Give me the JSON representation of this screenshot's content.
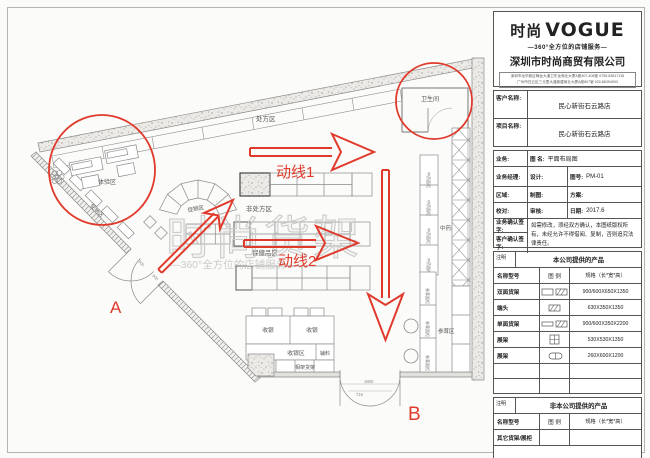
{
  "panel": {
    "logo_cn": "时尚",
    "logo_en": "VOGUE",
    "tagline": "—360°全方位的店铺服务—",
    "company": "深圳市时尚商贸有限公司",
    "address_line1": "深圳市龙华新区梅龙大道卫东龙商业大厦A座407-408室  0755-83617135",
    "address_line2": "广州市白云区三元里大道新建商业大厦A座807室  020-86394093",
    "info": {
      "client_label": "客户名称:",
      "client_value": "民心新街石云路店",
      "project_label": "项目名称:",
      "project_value": "民心新街石云路店"
    },
    "grid": {
      "yewu": "业务:",
      "tuming_label": "图 名:",
      "tuming_value": "平面布局图",
      "jingli": "业务经理:",
      "sheji": "设计:",
      "tuhao_label": "图号:",
      "tuhao_value": "PM-01",
      "quyu": "区域:",
      "zhitu": "制图:",
      "fangan": "方案:",
      "jiaodui": "校对:",
      "shenhe": "审核:",
      "riqi_label": "日期:",
      "riqi_value": "2017.6",
      "yewu_qianzi": "业务确认签字:",
      "kehu_qianzi": "客户确认签字:",
      "note": "如需修改，须经双方确认，本图纸版权所有，未经允许不得借阅、复制，否则追究法律责任。"
    },
    "products_company": {
      "note_label": "注明",
      "title": "本公司提供的产品",
      "col_name": "名称型号",
      "col_legend": "图 例",
      "col_spec": "规格（长*宽*高）",
      "rows": [
        {
          "name": "双面货架",
          "legend_icon": "double-sided-shelf-legend-icon",
          "spec": "900/600X650X1350"
        },
        {
          "name": "端头",
          "legend_icon": "endcap-legend-icon",
          "spec": "630X350X1350"
        },
        {
          "name": "单面货架",
          "legend_icon": "single-sided-shelf-legend-icon",
          "spec": "900/600X350X2200"
        },
        {
          "name": "展架",
          "legend_icon": "display-rack-legend-icon",
          "spec": "530X530X1350"
        },
        {
          "name": "展架",
          "legend_icon": "display-rack2-legend-icon",
          "spec": "260X600X1200"
        },
        {
          "name": "",
          "legend_icon": "",
          "spec": ""
        },
        {
          "name": "",
          "legend_icon": "",
          "spec": ""
        }
      ]
    },
    "products_other": {
      "note_label": "注明",
      "title": "非本公司提供的产品",
      "col_name": "名称型号",
      "col_legend": "图 例",
      "col_spec": "规格（长*宽*高）",
      "rows": [
        {
          "name": "其它货架/展柜",
          "legend_icon": "",
          "spec": ""
        }
      ]
    }
  },
  "plan": {
    "labels": {
      "prescription": "处方区",
      "toilet": "卫生间",
      "experience": "体验区",
      "promo_wall": "促销区",
      "promo_island": "促销区",
      "otc": "非处方区",
      "health": "保健品区",
      "tcm_area": "中药区",
      "ginseng_area": "参茸区",
      "cashier1": "收银",
      "cashier2": "收银",
      "cashier_area": "收银区",
      "accessories": "辅料",
      "bottom_shelf": "相架货架",
      "tcm_cabinet": "中药面柜",
      "ginseng_cabinet": "参茸面柜"
    },
    "flow1": "动线1",
    "flow2": "动线2",
    "door_a": "A",
    "door_b": "B",
    "dims": {
      "door_b_width": "1800",
      "door_b_depth": "715",
      "door_a_leaf": "900"
    },
    "watermark": {
      "line1": "时尚货架",
      "line2": "—360°全方位的店铺服务—"
    },
    "colors": {
      "annotation_red": "#e03a2c",
      "line_gray": "#888888",
      "watermark_gray": "#c8c8c8"
    }
  }
}
